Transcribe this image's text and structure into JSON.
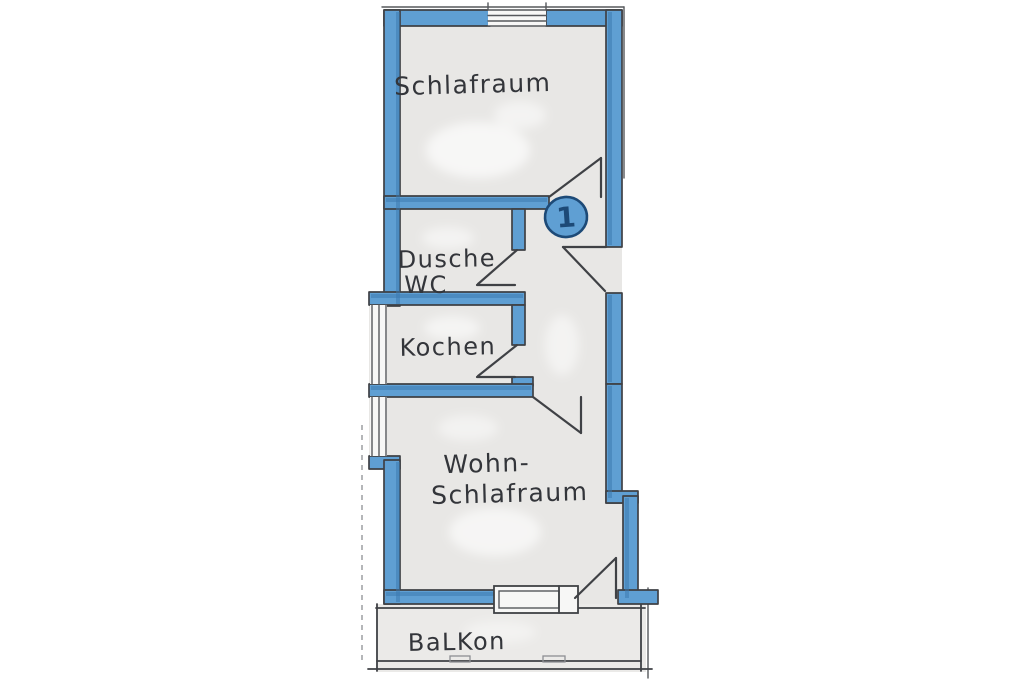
{
  "plan": {
    "unit_marker": "1",
    "rooms": {
      "schlafraum": {
        "label": "Schlafraum"
      },
      "dusche_wc": {
        "line1": "Dusche",
        "line2": "WC"
      },
      "kochen": {
        "label": "Kochen"
      },
      "wohn_schlafraum": {
        "line1": "Wohn-",
        "line2": "Schlafraum"
      },
      "balkon": {
        "label": "BaLKon"
      }
    },
    "features": {
      "doors": [
        "schlafraum-door",
        "apartment-entrance-door",
        "dusche-wc-door",
        "kochen-door",
        "wohn-schlafraum-door",
        "balcony-door"
      ],
      "windows": [
        "top-window",
        "kochen-side-window",
        "wohn-schlafraum-side-window",
        "balcony-window"
      ]
    },
    "colors": {
      "wall_blue": "#5f9fd3",
      "wall_blue_dark": "#3a78ad",
      "pencil": "#3f4145",
      "interior": "#e8e7e5",
      "interior_balcony": "#ebeae8",
      "paper": "#ffffff"
    }
  }
}
